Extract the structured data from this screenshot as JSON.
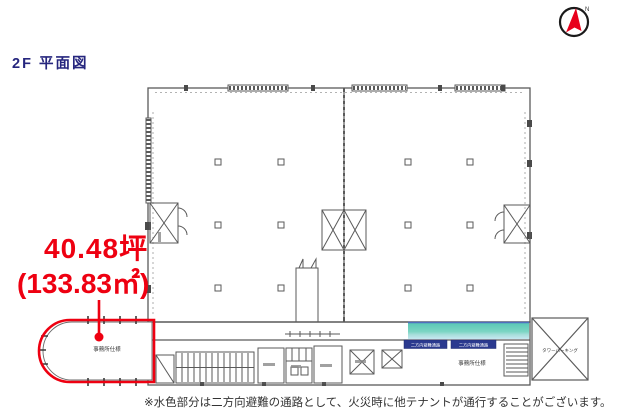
{
  "title": "2F 平面図",
  "compass": {
    "label": "N"
  },
  "annotation": {
    "area_tsubo": "40.48坪",
    "area_sqm": "(133.83㎡)"
  },
  "plan": {
    "left_unit_label": "事務所仕様",
    "right_unit_label": "事務所仕様",
    "parking_label": "タワーパーキング",
    "corridor_badge_1": "二方向避難通路",
    "corridor_badge_2": "二方向避難通路",
    "colors": {
      "highlight_red": "#ee0011",
      "title_navy": "#26267e",
      "corridor_teal": "#66cfba",
      "badge_navy": "#2b3a8f",
      "plan_line": "#5a5a5a"
    }
  },
  "footnote": "※水色部分は二方向避難の通路として、火災時に他テナントが通行することがございます。"
}
